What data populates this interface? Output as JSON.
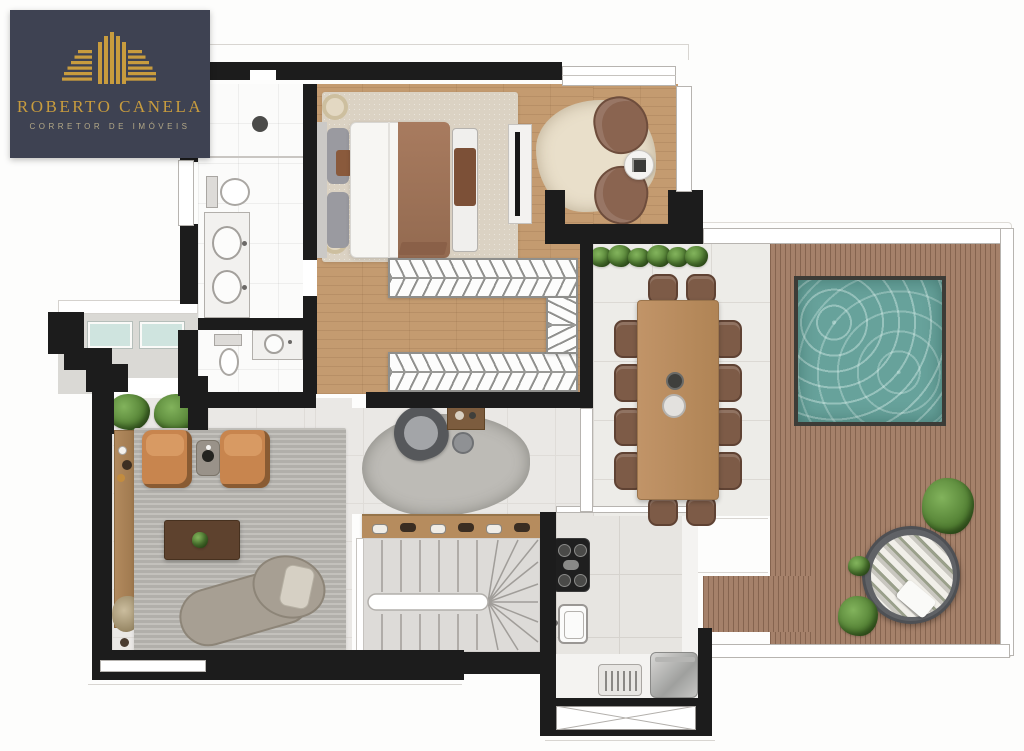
{
  "logo": {
    "title": "ROBERTO CANELA",
    "subtitle": "CORRETOR DE IMÓVEIS",
    "icon": "buildings-logo-icon",
    "background": "#3e4252",
    "gold": "#c89c3e"
  },
  "palette": {
    "wall": "#1c1c1c",
    "wood_floor": "#c49b70",
    "deck_wood": "#a5816a",
    "pool_water": "#67a29b",
    "dining_tile": "#edece8",
    "bedroom_rug": "#dbd2c3",
    "living_rug": "#b8b6b1",
    "armchair_tan": "#c8854e",
    "dining_chair": "#7d5b47",
    "hedge_green": "#527f33",
    "daybed_gray": "#606266",
    "glass_teal": "#cfe4df"
  }
}
